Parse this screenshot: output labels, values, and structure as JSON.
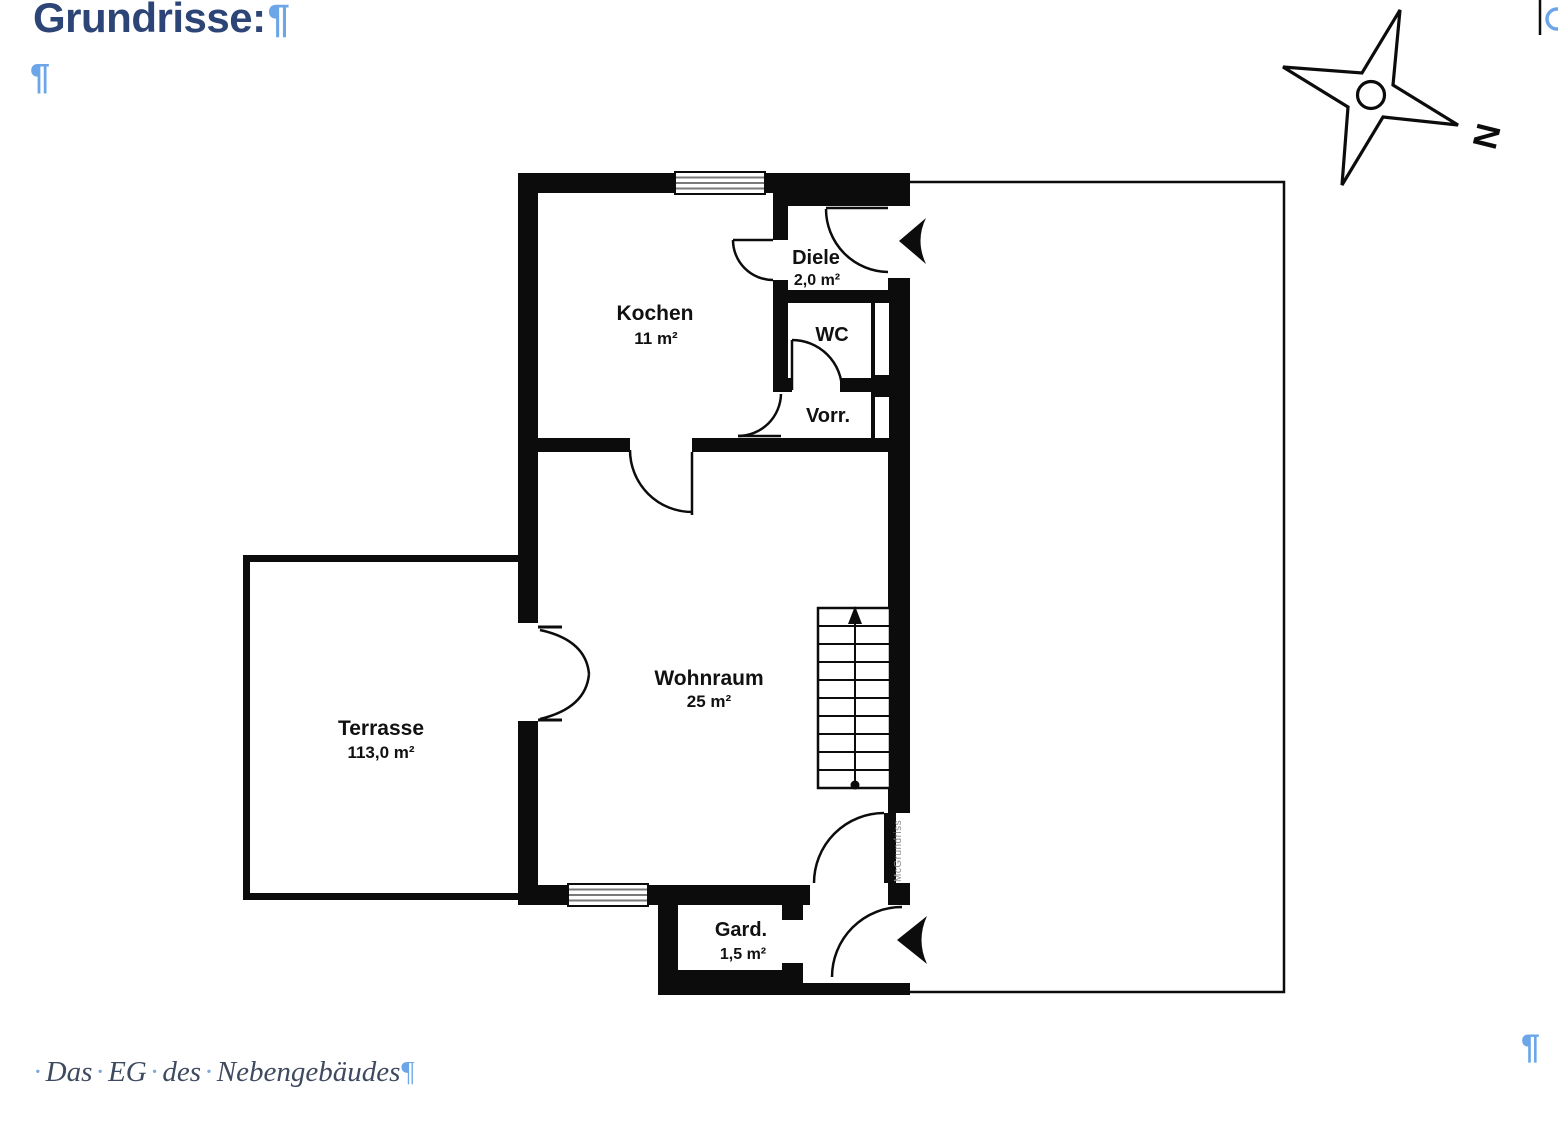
{
  "document": {
    "heading": "Grundrisse:",
    "heading_pilcrow": "¶",
    "empty_paragraph_pilcrow": "¶",
    "bottom_right_pilcrow": "¶",
    "caption": {
      "separator": "·",
      "words": [
        "Das",
        "EG",
        "des",
        "Nebengebäudes"
      ],
      "pilcrow": "¶"
    }
  },
  "floor_plan": {
    "rooms": [
      {
        "name": "Kochen",
        "area": "11 m²"
      },
      {
        "name": "Diele",
        "area": "2,0 m²"
      },
      {
        "name": "WC"
      },
      {
        "name": "Vorr."
      },
      {
        "name": "Wohnraum",
        "area": "25 m²"
      },
      {
        "name": "Terrasse",
        "area": "113,0 m²"
      },
      {
        "name": "Gard.",
        "area": "1,5 m²"
      }
    ],
    "watermark": "McGrundriss",
    "compass_label": "N"
  },
  "colors": {
    "heading": "#2d4576",
    "pilcrow_blue": "#6ca6e8",
    "caption_text": "#3e4a5f",
    "caption_dot": "#7fa8dc",
    "wall_black": "#0c0c0c",
    "window_line_gray": "#7a7a7a",
    "watermark_gray": "#8a8a8a"
  }
}
